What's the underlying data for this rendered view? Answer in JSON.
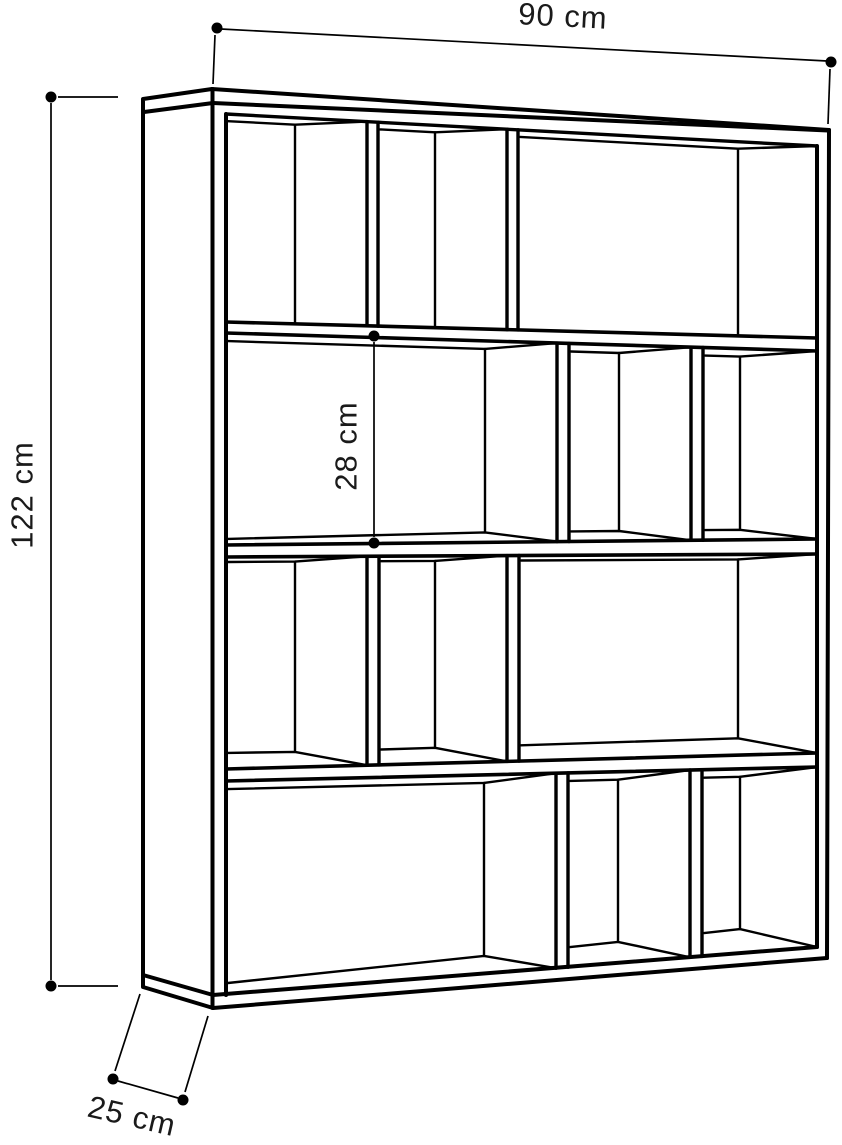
{
  "page": {
    "background": "#ffffff",
    "line_color": "#000000",
    "text_color": "#1a1a1a"
  },
  "figure": {
    "kind": "bookcase dimension drawing",
    "rows": 4,
    "shelves": 3,
    "compartments_per_row": 3
  },
  "dimensions": {
    "width": {
      "label": "90 cm",
      "position": "top"
    },
    "height": {
      "label": "122 cm",
      "position": "left"
    },
    "inner_shelf_height": {
      "label": "28 cm",
      "position": "interior-second-row"
    },
    "depth": {
      "label": "25 cm",
      "position": "bottom-left"
    }
  }
}
